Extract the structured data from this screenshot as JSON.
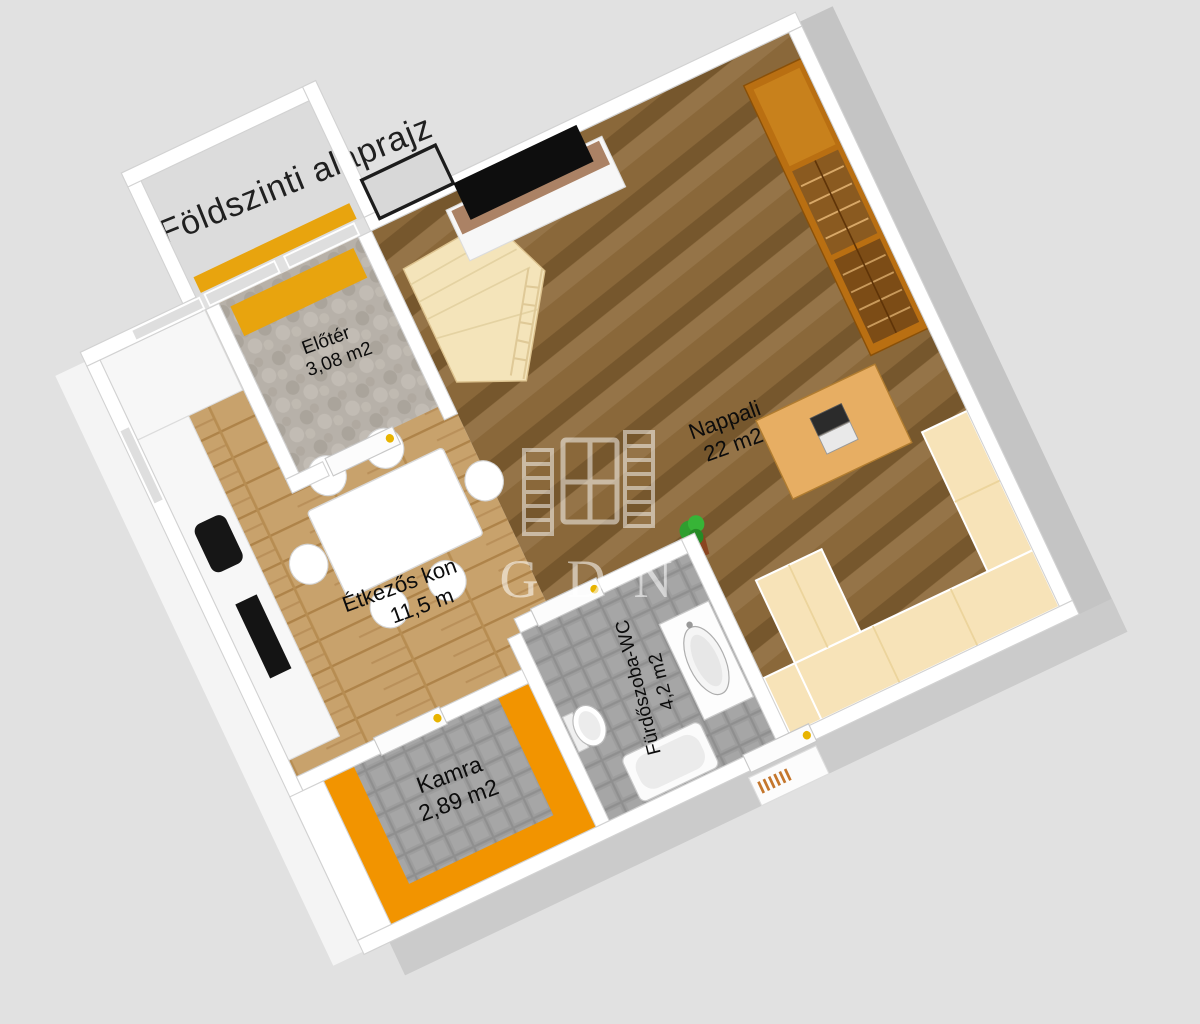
{
  "title": "Földszinti alaprajz",
  "watermark": "GDN",
  "rooms": [
    {
      "id": "eloter",
      "name": "Előtér",
      "area": "3,08 m2"
    },
    {
      "id": "nappali",
      "name": "Nappali",
      "area": "22 m2"
    },
    {
      "id": "etkezo",
      "name": "Étkezős kon",
      "area": "11,5 m"
    },
    {
      "id": "furdo",
      "name": "Fürdőszoba-WC",
      "area": "4,2 m2"
    },
    {
      "id": "kamra",
      "name": "Kamra",
      "area": "2,89 m2"
    }
  ],
  "colors": {
    "background": "#e1e1e1",
    "wall": "#ffffff",
    "exterior_shade": "#c4c4c4",
    "wood_living": "#8a683a",
    "wood_dining": "#c8a26c",
    "tile_gray": "#9b9b9b",
    "cobble_gray": "#b7b1a9",
    "accent_orange": "#f29400",
    "mat_ocher": "#e8a40e",
    "wardrobe_orange": "#b96f12",
    "wardrobe_brown": "#7c4c16",
    "sofa_cream": "#f7e3b8",
    "stairs_cream": "#f4e4ba",
    "desk_wood": "#e7ae63",
    "tv_black": "#0e0e0e",
    "shelf_brown": "#ab8265",
    "label_text": "#0c0c0c"
  }
}
